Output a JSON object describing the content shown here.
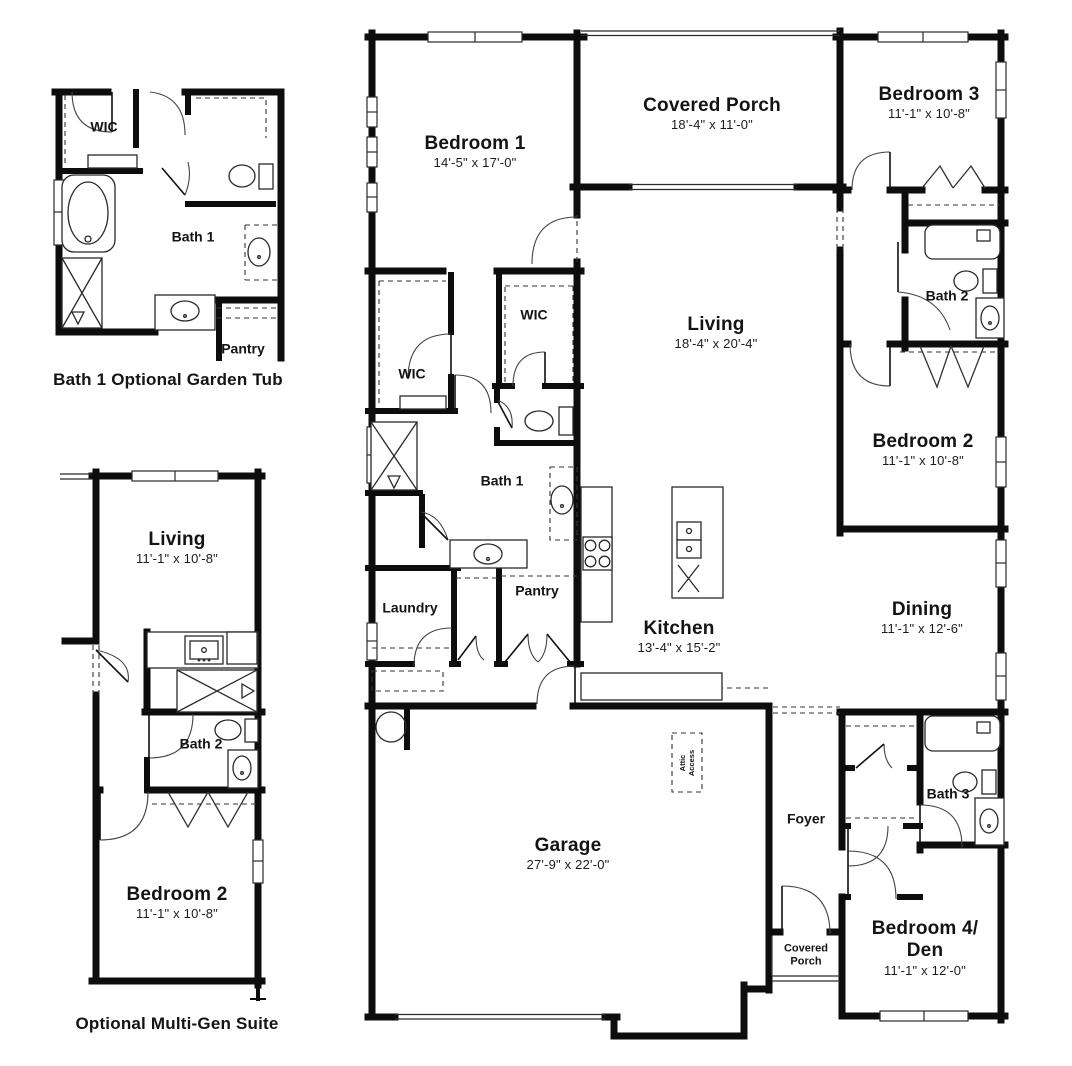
{
  "main": {
    "bedroom1_name": "Bedroom 1",
    "bedroom1_dims": "14'-5\" x 17'-0\"",
    "porch_name": "Covered Porch",
    "porch_dims": "18'-4\" x 11'-0\"",
    "bedroom3_name": "Bedroom 3",
    "bedroom3_dims": "11'-1\" x 10'-8\"",
    "living_name": "Living",
    "living_dims": "18'-4\" x 20'-4\"",
    "bath2": "Bath 2",
    "bedroom2_name": "Bedroom 2",
    "bedroom2_dims": "11'-1\" x 10'-8\"",
    "wic_top": "WIC",
    "wic_left": "WIC",
    "bath1": "Bath 1",
    "laundry": "Laundry",
    "pantry": "Pantry",
    "kitchen_name": "Kitchen",
    "kitchen_dims": "13'-4\" x 15'-2\"",
    "dining_name": "Dining",
    "dining_dims": "11'-1\" x 12'-6\"",
    "garage_name": "Garage",
    "garage_dims": "27'-9\" x 22'-0\"",
    "attic_line1": "Attic",
    "attic_line2": "Access",
    "foyer": "Foyer",
    "bath3": "Bath 3",
    "porch2_line1": "Covered",
    "porch2_line2": "Porch",
    "bedroom4_name1": "Bedroom 4/",
    "bedroom4_name2": "Den",
    "bedroom4_dims": "11'-1\" x 12'-0\""
  },
  "inset_garden_tub": {
    "wic": "WIC",
    "bath": "Bath 1",
    "pantry": "Pantry",
    "caption": "Bath 1 Optional Garden Tub"
  },
  "inset_multigen": {
    "living_name": "Living",
    "living_dims": "11'-1\" x 10'-8\"",
    "bath": "Bath 2",
    "bedroom_name": "Bedroom 2",
    "bedroom_dims": "11'-1\" x 10'-8\"",
    "caption": "Optional Multi-Gen Suite"
  },
  "colors": {
    "ink": "#0d0d0d",
    "line": "#2a2a2a",
    "paper": "#ffffff"
  }
}
